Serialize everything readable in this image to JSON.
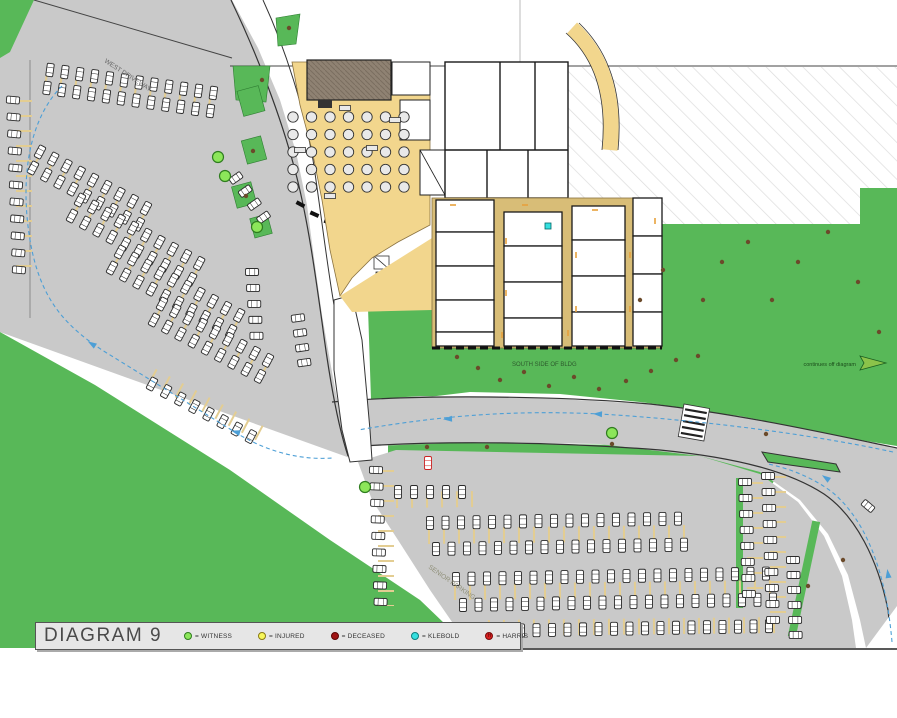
{
  "title": "DIAGRAM 9",
  "legend": {
    "items": [
      {
        "label": "= WITNESS",
        "color": "#8ce65a",
        "border": "#2f7d1f",
        "glyph": ""
      },
      {
        "label": "= INJURED",
        "color": "#f7f75a",
        "border": "#8a7a12",
        "glyph": ""
      },
      {
        "label": "= DECEASED",
        "color": "#a01414",
        "border": "#5d0606",
        "glyph": ""
      },
      {
        "label": "= KLEBOLD",
        "color": "#35e0e0",
        "border": "#0d7f7f",
        "glyph": ""
      },
      {
        "label": "= HARRIS",
        "color": "#d92020",
        "border": "#7a0c0c",
        "glyph": "H"
      }
    ]
  },
  "labels": {
    "south_lawn": "SOUTH SIDE OF BLDG",
    "off_diagram": "continues off diagram",
    "west_drive": "WEST DRIVEWAY",
    "senior_parking": "SENIOR PARKING"
  },
  "colors": {
    "grass": "#58b858",
    "lot": "#c9c9c9",
    "tan": "#f2d68d",
    "tan2": "#d8bd77",
    "stall": "#e3cd92",
    "route": "#4d9fd6",
    "wall": "#222222",
    "witness_green": "#8ce65a",
    "witness_border": "#2f7d1f",
    "klebold_cyan": "#35e0e0",
    "harris_red": "#cc2222",
    "tree_brown": "#6b4a2a",
    "legendbg": "#e6e6e6"
  },
  "map": {
    "car_rows": [
      {
        "x": 50,
        "y": 70,
        "n": 12,
        "step": 15,
        "dir": 8,
        "car": 98
      },
      {
        "x": 47,
        "y": 88,
        "n": 12,
        "step": 15,
        "dir": 8,
        "car": 98
      },
      {
        "x": 13,
        "y": 100,
        "n": 11,
        "step": 17,
        "dir": 88,
        "car": 5
      },
      {
        "x": 40,
        "y": 152,
        "n": 9,
        "step": 15,
        "dir": 28,
        "car": 118
      },
      {
        "x": 33,
        "y": 168,
        "n": 9,
        "step": 15,
        "dir": 28,
        "car": 118
      },
      {
        "x": 80,
        "y": 200,
        "n": 10,
        "step": 15,
        "dir": 28,
        "car": 118
      },
      {
        "x": 72,
        "y": 216,
        "n": 10,
        "step": 15,
        "dir": 28,
        "car": 118
      },
      {
        "x": 120,
        "y": 252,
        "n": 10,
        "step": 15,
        "dir": 28,
        "car": 118
      },
      {
        "x": 112,
        "y": 268,
        "n": 10,
        "step": 15,
        "dir": 28,
        "car": 118
      },
      {
        "x": 162,
        "y": 304,
        "n": 9,
        "step": 15,
        "dir": 28,
        "car": 118
      },
      {
        "x": 154,
        "y": 320,
        "n": 9,
        "step": 15,
        "dir": 28,
        "car": 118
      },
      {
        "x": 152,
        "y": 384,
        "n": 8,
        "step": 16,
        "dir": 28,
        "car": 118
      },
      {
        "x": 236,
        "y": 178,
        "n": 4,
        "step": 16,
        "dir": 55,
        "car": 145
      },
      {
        "x": 252,
        "y": 272,
        "n": 5,
        "step": 16,
        "dir": 86,
        "car": 0
      },
      {
        "x": 298,
        "y": 318,
        "n": 4,
        "step": 15,
        "dir": 82,
        "car": -8
      },
      {
        "x": 398,
        "y": 492,
        "n": 5,
        "step": 16,
        "dir": 0,
        "car": 90
      },
      {
        "x": 430,
        "y": 523,
        "n": 17,
        "step": 15.5,
        "dir": -1,
        "car": 90
      },
      {
        "x": 436,
        "y": 549,
        "n": 17,
        "step": 15.5,
        "dir": -1,
        "car": 90
      },
      {
        "x": 456,
        "y": 579,
        "n": 21,
        "step": 15.5,
        "dir": -1,
        "car": 90
      },
      {
        "x": 463,
        "y": 605,
        "n": 21,
        "step": 15.5,
        "dir": -1,
        "car": 90
      },
      {
        "x": 490,
        "y": 631,
        "n": 19,
        "step": 15.5,
        "dir": -1,
        "car": 90
      },
      {
        "x": 376,
        "y": 470,
        "n": 9,
        "step": 16.5,
        "dir": 88,
        "car": 2
      },
      {
        "x": 745,
        "y": 482,
        "n": 8,
        "step": 16,
        "dir": 88,
        "car": 0
      },
      {
        "x": 768,
        "y": 476,
        "n": 10,
        "step": 16,
        "dir": 88,
        "car": 0
      },
      {
        "x": 793,
        "y": 560,
        "n": 6,
        "step": 15,
        "dir": 88,
        "car": 0
      }
    ],
    "single_cars": [
      {
        "x": 868,
        "y": 506,
        "a": 40
      }
    ],
    "harris_vehicle": {
      "x": 428,
      "y": 463,
      "a": 90
    },
    "stall_strips": [
      {
        "x1": 45,
        "y1": 80,
        "x2": 216,
        "y2": 104
      },
      {
        "x1": 36,
        "y1": 160,
        "x2": 149,
        "y2": 220
      },
      {
        "x1": 76,
        "y1": 208,
        "x2": 202,
        "y2": 275
      },
      {
        "x1": 116,
        "y1": 260,
        "x2": 242,
        "y2": 327
      },
      {
        "x1": 158,
        "y1": 312,
        "x2": 271,
        "y2": 372
      },
      {
        "x1": 152,
        "y1": 376,
        "x2": 265,
        "y2": 436
      },
      {
        "x1": 24,
        "y1": 100,
        "x2": 24,
        "y2": 274
      },
      {
        "x1": 396,
        "y1": 500,
        "x2": 478,
        "y2": 499
      },
      {
        "x1": 428,
        "y1": 536,
        "x2": 690,
        "y2": 533
      },
      {
        "x1": 454,
        "y1": 592,
        "x2": 778,
        "y2": 588
      },
      {
        "x1": 488,
        "y1": 628,
        "x2": 788,
        "y2": 625
      },
      {
        "x1": 386,
        "y1": 470,
        "x2": 386,
        "y2": 606
      },
      {
        "x1": 755,
        "y1": 482,
        "x2": 755,
        "y2": 594
      },
      {
        "x1": 778,
        "y1": 476,
        "x2": 778,
        "y2": 620
      }
    ],
    "tables": {
      "x0": 293,
      "y0": 117,
      "dx": 18.5,
      "dy": 17.5,
      "cols": 7,
      "rows": 5,
      "r": 5.2
    },
    "rect_tables": [
      [
        345,
        108
      ],
      [
        300,
        150
      ],
      [
        372,
        148
      ],
      [
        330,
        196
      ],
      [
        395,
        120
      ]
    ],
    "trees": [
      [
        457,
        357
      ],
      [
        478,
        368
      ],
      [
        500,
        380
      ],
      [
        524,
        372
      ],
      [
        549,
        386
      ],
      [
        574,
        377
      ],
      [
        599,
        389
      ],
      [
        626,
        381
      ],
      [
        651,
        371
      ],
      [
        676,
        360
      ],
      [
        698,
        356
      ],
      [
        703,
        300
      ],
      [
        722,
        262
      ],
      [
        748,
        242
      ],
      [
        772,
        300
      ],
      [
        798,
        262
      ],
      [
        828,
        232
      ],
      [
        858,
        282
      ],
      [
        879,
        332
      ],
      [
        766,
        434
      ],
      [
        808,
        586
      ],
      [
        843,
        560
      ],
      [
        640,
        300
      ],
      [
        663,
        270
      ],
      [
        427,
        447
      ],
      [
        487,
        447
      ],
      [
        612,
        444
      ],
      [
        253,
        151
      ],
      [
        246,
        196
      ],
      [
        289,
        28
      ],
      [
        262,
        80
      ]
    ],
    "witnesses": [
      [
        218,
        157
      ],
      [
        225,
        176
      ],
      [
        257,
        227
      ],
      [
        612,
        433
      ],
      [
        365,
        487
      ]
    ],
    "klebold": [
      [
        548,
        226
      ]
    ],
    "routes": [
      "M 62,86 C 28,120 20,180 30,240 C 40,300 66,326 102,350 L 238,434 C 272,454 304,460 332,458",
      "M 893,452 C 810,434 700,420 600,414 C 515,410 445,415 358,430",
      "M 892,642 C 886,572 866,520 832,492 C 812,477 788,468 768,464"
    ],
    "route_arrows": [
      {
        "x": 92,
        "y": 344,
        "r": 212
      },
      {
        "x": 236,
        "y": 432,
        "r": 196
      },
      {
        "x": 598,
        "y": 414,
        "r": 183
      },
      {
        "x": 448,
        "y": 419,
        "r": 177
      },
      {
        "x": 826,
        "y": 478,
        "r": 215
      },
      {
        "x": 888,
        "y": 574,
        "r": 262
      }
    ],
    "doors": [
      [
        506,
        238,
        1
      ],
      [
        506,
        290,
        1
      ],
      [
        576,
        252,
        1
      ],
      [
        576,
        306,
        1
      ],
      [
        568,
        330,
        1
      ],
      [
        502,
        332,
        1
      ],
      [
        630,
        252,
        1
      ],
      [
        630,
        306,
        1
      ],
      [
        655,
        218,
        1
      ],
      [
        450,
        205,
        0
      ],
      [
        522,
        205,
        0
      ],
      [
        592,
        210,
        0
      ]
    ]
  }
}
